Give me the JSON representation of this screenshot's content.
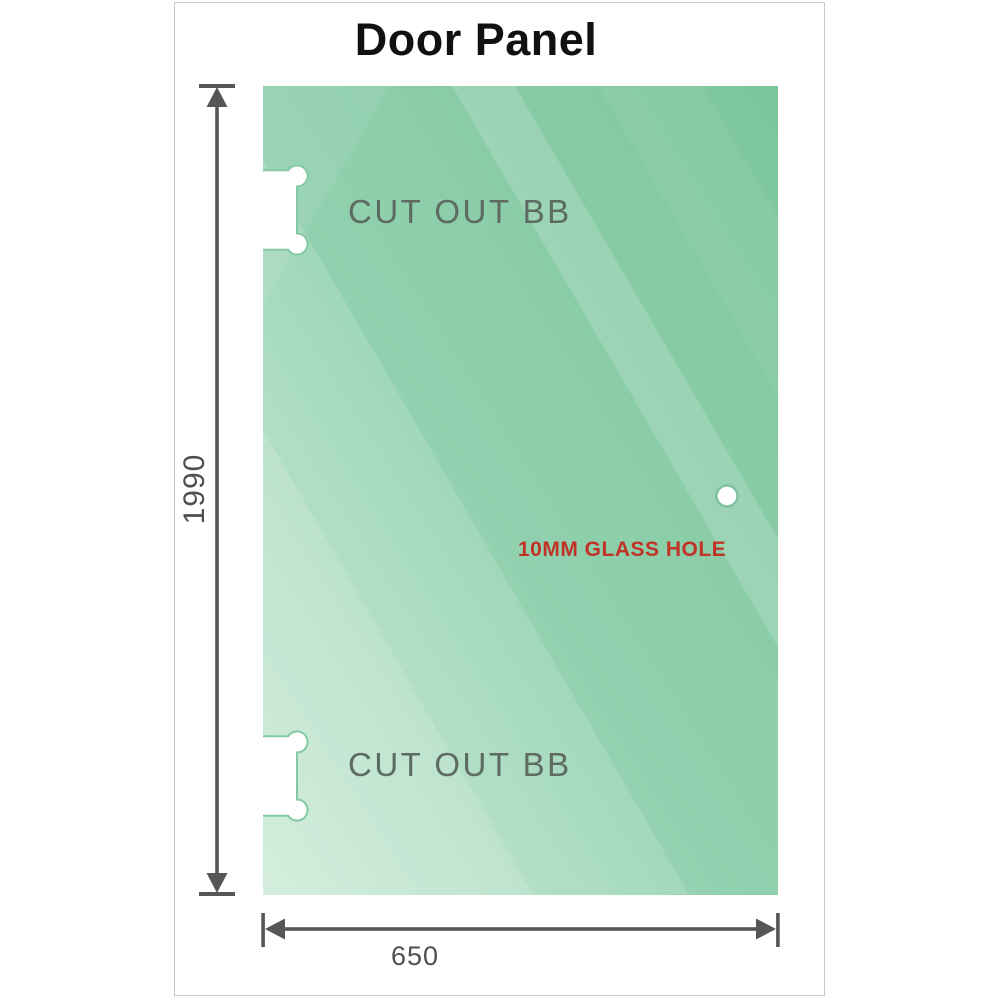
{
  "title": "Door Panel",
  "glass_panel": {
    "cutouts": [
      {
        "label": "CUT OUT BB",
        "position": "top-left-edge"
      },
      {
        "label": "CUT OUT BB",
        "position": "bottom-left-edge"
      }
    ],
    "hole": {
      "label": "10MM GLASS HOLE",
      "diameter_mm": 10,
      "position": "right-middle"
    }
  },
  "dimensions": {
    "height_mm": "1990",
    "width_mm": "650"
  },
  "colors": {
    "glass_dark": "#7cc69c",
    "glass_mid": "#92d1af",
    "glass_light": "#c7e9d4",
    "cutout_outline": "#85c9a3",
    "hole_outline": "#7fc29d",
    "dimension_line": "#565656",
    "dimension_text": "#4f4f4f",
    "cutout_label_text": "#5d6b63",
    "hole_label_text": "#c13326",
    "title_text": "#111111",
    "frame_border": "#c8c8c8"
  }
}
